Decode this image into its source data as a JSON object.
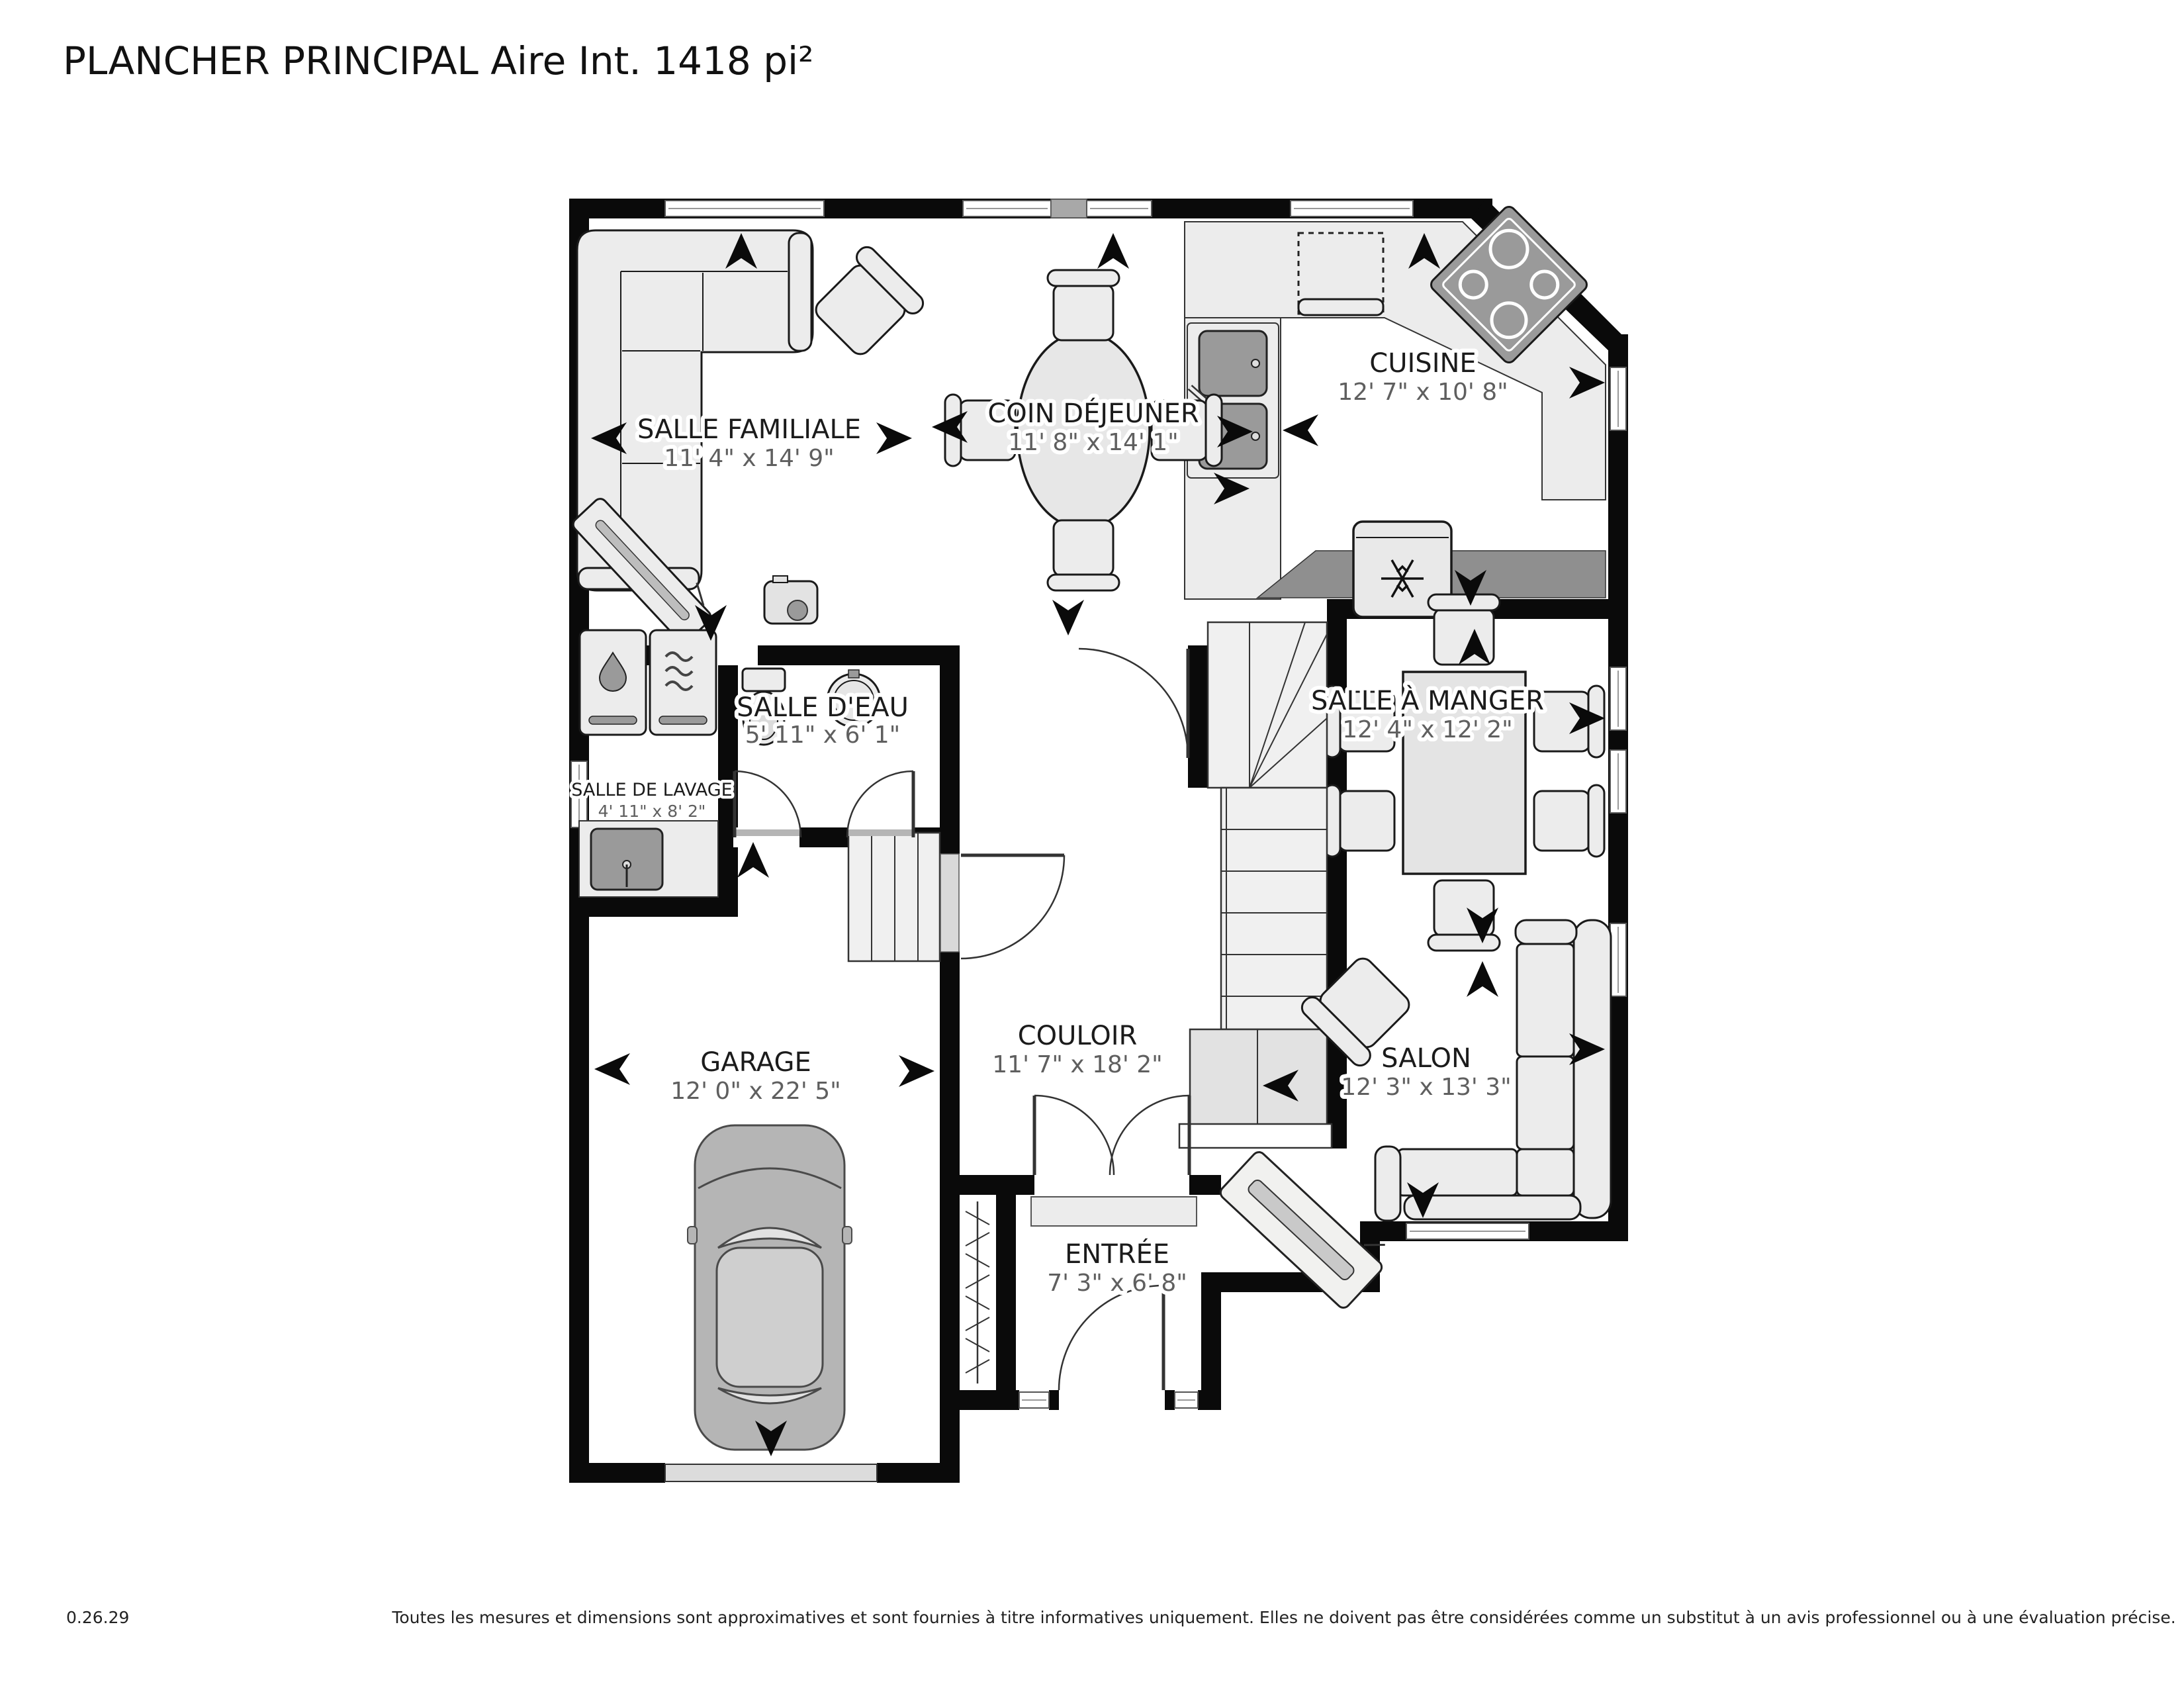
{
  "title": "PLANCHER PRINCIPAL Aire Int. 1418 pi²",
  "rooms": [
    {
      "name": "SALLE FAMILIALE",
      "dims": "11' 4\" x 14' 9\""
    },
    {
      "name": "COIN DÉJEUNER",
      "dims": "11' 8\" x 14' 1\""
    },
    {
      "name": "CUISINE",
      "dims": "12' 7\" x 10' 8\""
    },
    {
      "name": "SALLE D'EAU",
      "dims": "5' 11\" x 6' 1\""
    },
    {
      "name": "SALLE DE LAVAGE",
      "dims": "4' 11\" x 8' 2\""
    },
    {
      "name": "SALLE À MANGER",
      "dims": "12' 4\" x 12' 2\""
    },
    {
      "name": "GARAGE",
      "dims": "12' 0\" x 22' 5\""
    },
    {
      "name": "COULOIR",
      "dims": "11' 7\" x 18' 2\""
    },
    {
      "name": "SALON",
      "dims": "12' 3\" x 13' 3\""
    },
    {
      "name": "ENTRÉE",
      "dims": "7' 3\" x 6' 8\""
    }
  ],
  "footer": {
    "version": "0.26.29",
    "disclaimer": "Toutes les mesures et dimensions sont approximatives et sont fournies à titre informatives uniquement. Elles ne doivent pas être considérées comme un substitut à un avis professionnel ou à une évaluation précise."
  },
  "icons": {
    "direction_arrow": "solid chevron arrow marking openings and windows",
    "snowflake_icon": "refrigerator symbol",
    "droplet_icon": "washer symbol",
    "waves_icon": "dryer symbol"
  }
}
